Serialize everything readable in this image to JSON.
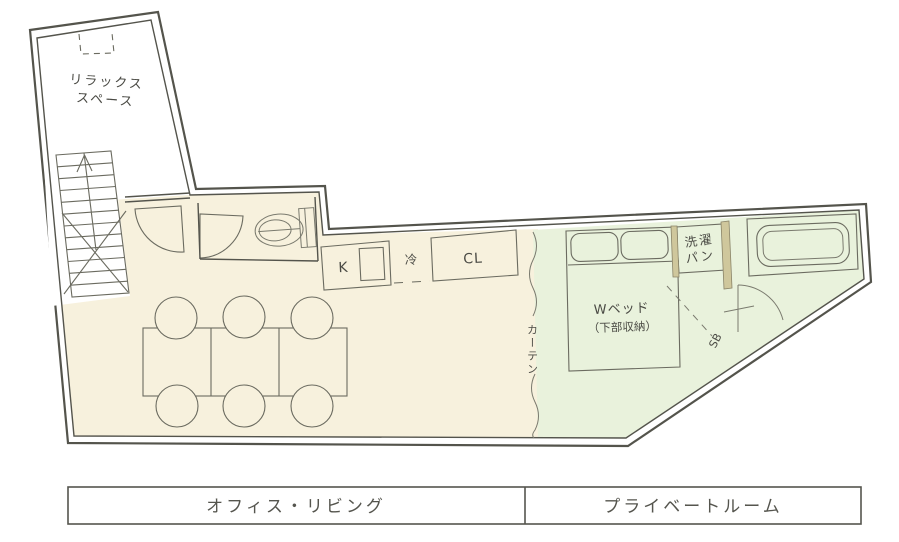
{
  "floorplan": {
    "relax_space": {
      "line1": "リラックス",
      "line2": "スペース"
    },
    "kitchen": {
      "k": "K",
      "fridge": "冷",
      "closet": "CL"
    },
    "curtain": "カーテン",
    "bed": {
      "line1": "Wベッド",
      "line2": "（下部収納）"
    },
    "laundry": {
      "line1": "洗濯",
      "line2": "パン"
    },
    "sb_label": "SB",
    "legend": {
      "left": "オフィス・リビング",
      "right": "プライベートルーム"
    },
    "colors": {
      "office_fill": "#f7f1dd",
      "private_fill": "#e9f2dc",
      "wall": "#54544c",
      "partition_tan": "#cfc79c"
    }
  }
}
